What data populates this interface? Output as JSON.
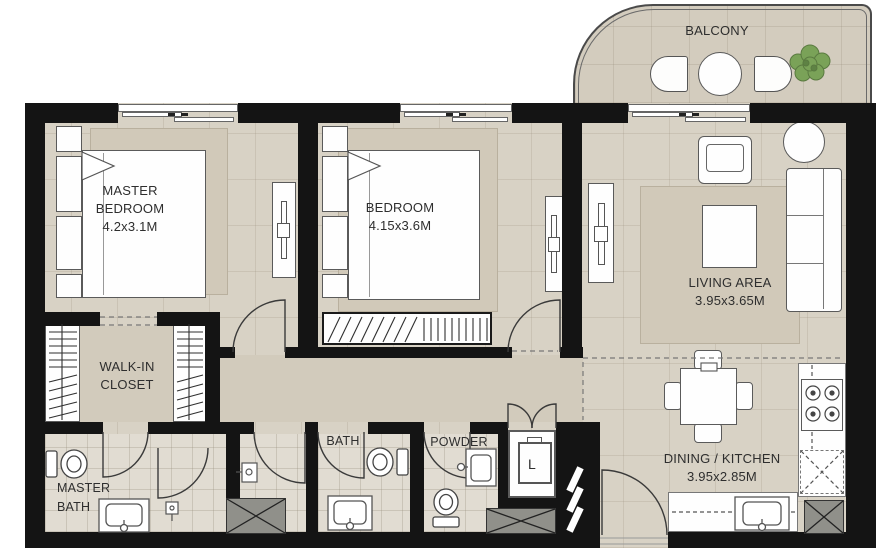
{
  "plan_type": "apartment-floor-plan",
  "rooms": {
    "master_bedroom": {
      "name_line1": "MASTER",
      "name_line2": "BEDROOM",
      "dimensions": "4.2x3.1M"
    },
    "bedroom": {
      "name_line1": "BEDROOM",
      "dimensions": "4.15x3.6M"
    },
    "living_area": {
      "name_line1": "LIVING AREA",
      "dimensions": "3.95x3.65M"
    },
    "dining_kitchen": {
      "name_line1": "DINING / KITCHEN",
      "dimensions": "3.95x2.85M"
    },
    "walk_in_closet": {
      "name_line1": "WALK-IN",
      "name_line2": "CLOSET"
    },
    "master_bath": {
      "name_line1": "MASTER",
      "name_line2": "BATH"
    },
    "bath": {
      "name_line1": "BATH"
    },
    "powder": {
      "name_line1": "POWDER"
    },
    "laundry": {
      "name_line1": "L"
    },
    "balcony": {
      "name_line1": "BALCONY"
    }
  },
  "colors": {
    "wall": "#141414",
    "floor": "#d8d2c5",
    "hall_floor": "#d2cbbc",
    "bathroom_tile": "#e1dcd2",
    "balcony_floor": "#d3ccbe",
    "rug": "#d1c9b9",
    "plant_green": "#7aa258"
  }
}
